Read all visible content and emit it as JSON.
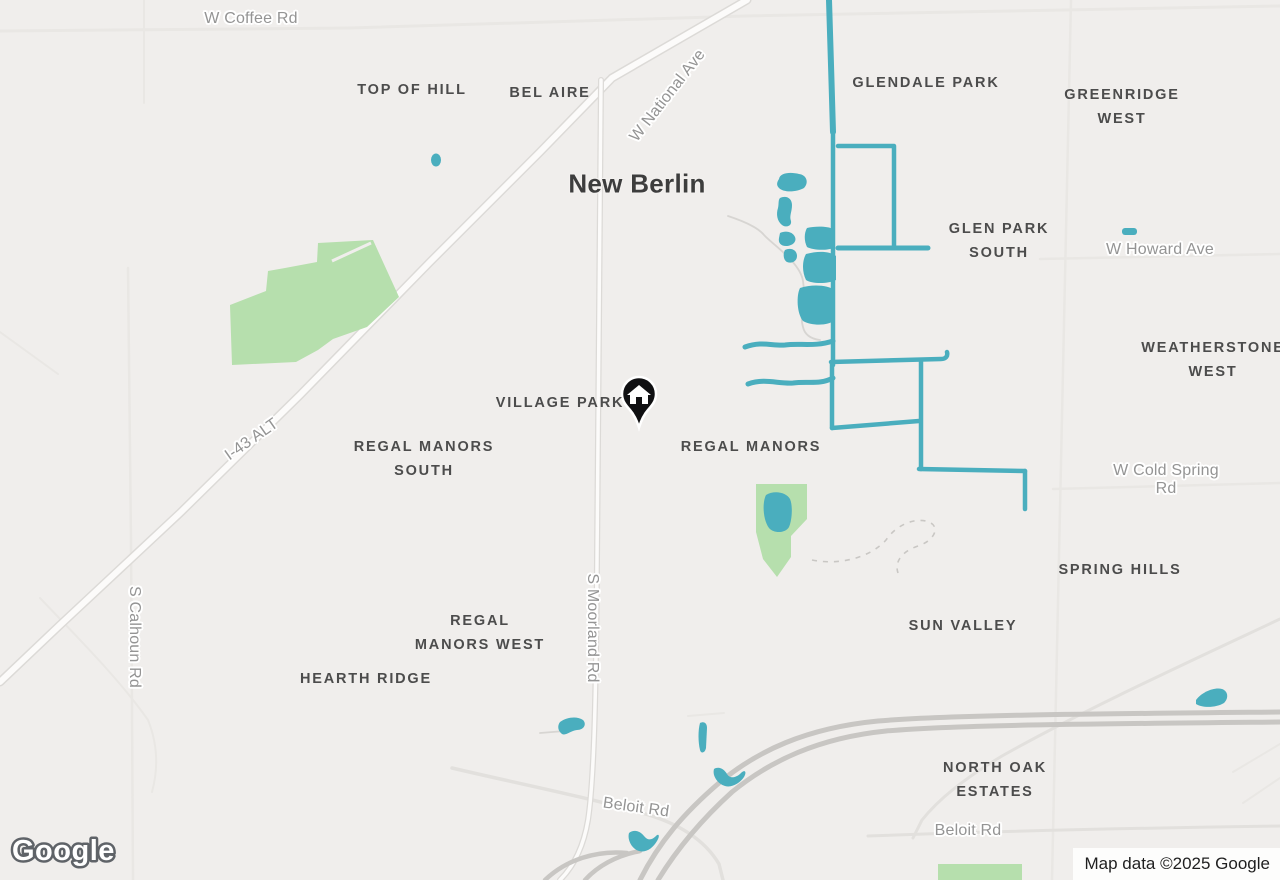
{
  "map": {
    "type": "road-map",
    "city_label": "New Berlin",
    "colors": {
      "background": "#f0eeec",
      "water": "#4aaebe",
      "park": "#b6dfad",
      "road_minor": "#e9e7e4",
      "road_major_casing": "#dcdad7",
      "road_major_fill": "#fcfbfa",
      "highway": "#c8c6c3",
      "trail_dashed": "#c9c7c4",
      "creek_line": "#d7d5d2",
      "label_neighborhood": "#4c4c4c",
      "label_road": "#949494",
      "label_city": "#3d3d3d",
      "marker": "#101012"
    },
    "neighborhood_labels": [
      {
        "text": "TOP OF HILL",
        "x": 412,
        "y": 90
      },
      {
        "text": "BEL AIRE",
        "x": 550,
        "y": 93
      },
      {
        "text": "GLENDALE PARK",
        "x": 926,
        "y": 83
      },
      {
        "text": "GREENRIDGE\nWEST",
        "x": 1122,
        "y": 107
      },
      {
        "text": "GLEN PARK\nSOUTH",
        "x": 999,
        "y": 241
      },
      {
        "text": "WEATHERSTONE\nWEST",
        "x": 1213,
        "y": 360
      },
      {
        "text": "VILLAGE PARK",
        "x": 560,
        "y": 403
      },
      {
        "text": "REGAL MANORS\nSOUTH",
        "x": 424,
        "y": 459
      },
      {
        "text": "REGAL MANORS",
        "x": 751,
        "y": 447
      },
      {
        "text": "SPRING HILLS",
        "x": 1120,
        "y": 570
      },
      {
        "text": "SUN VALLEY",
        "x": 963,
        "y": 626
      },
      {
        "text": "REGAL\nMANORS WEST",
        "x": 480,
        "y": 633
      },
      {
        "text": "HEARTH RIDGE",
        "x": 366,
        "y": 679
      },
      {
        "text": "NORTH OAK\nESTATES",
        "x": 995,
        "y": 780
      }
    ],
    "road_labels": [
      {
        "text": "W Coffee Rd",
        "x": 251,
        "y": 19,
        "rot": 0
      },
      {
        "text": "W National Ave",
        "x": 668,
        "y": 96,
        "rot": -52
      },
      {
        "text": "I-43 ALT",
        "x": 252,
        "y": 440,
        "rot": -35
      },
      {
        "text": "W Howard Ave",
        "x": 1160,
        "y": 250,
        "rot": 0
      },
      {
        "text": "W Cold Spring Rd",
        "x": 1166,
        "y": 480,
        "rot": 0
      },
      {
        "text": "S Calhoun Rd",
        "x": 134,
        "y": 637,
        "rot": 90
      },
      {
        "text": "S Moorland Rd",
        "x": 592,
        "y": 628,
        "rot": 90
      },
      {
        "text": "Beloit Rd",
        "x": 636,
        "y": 808,
        "rot": 8
      },
      {
        "text": "Beloit Rd",
        "x": 968,
        "y": 831,
        "rot": 0
      }
    ],
    "city": {
      "text": "New Berlin",
      "x": 637,
      "y": 184
    },
    "marker": {
      "kind": "saved-place-home-pin",
      "x": 639,
      "y": 394
    },
    "footer": {
      "logo": "Google",
      "attribution": "Map data ©2025 Google"
    }
  }
}
